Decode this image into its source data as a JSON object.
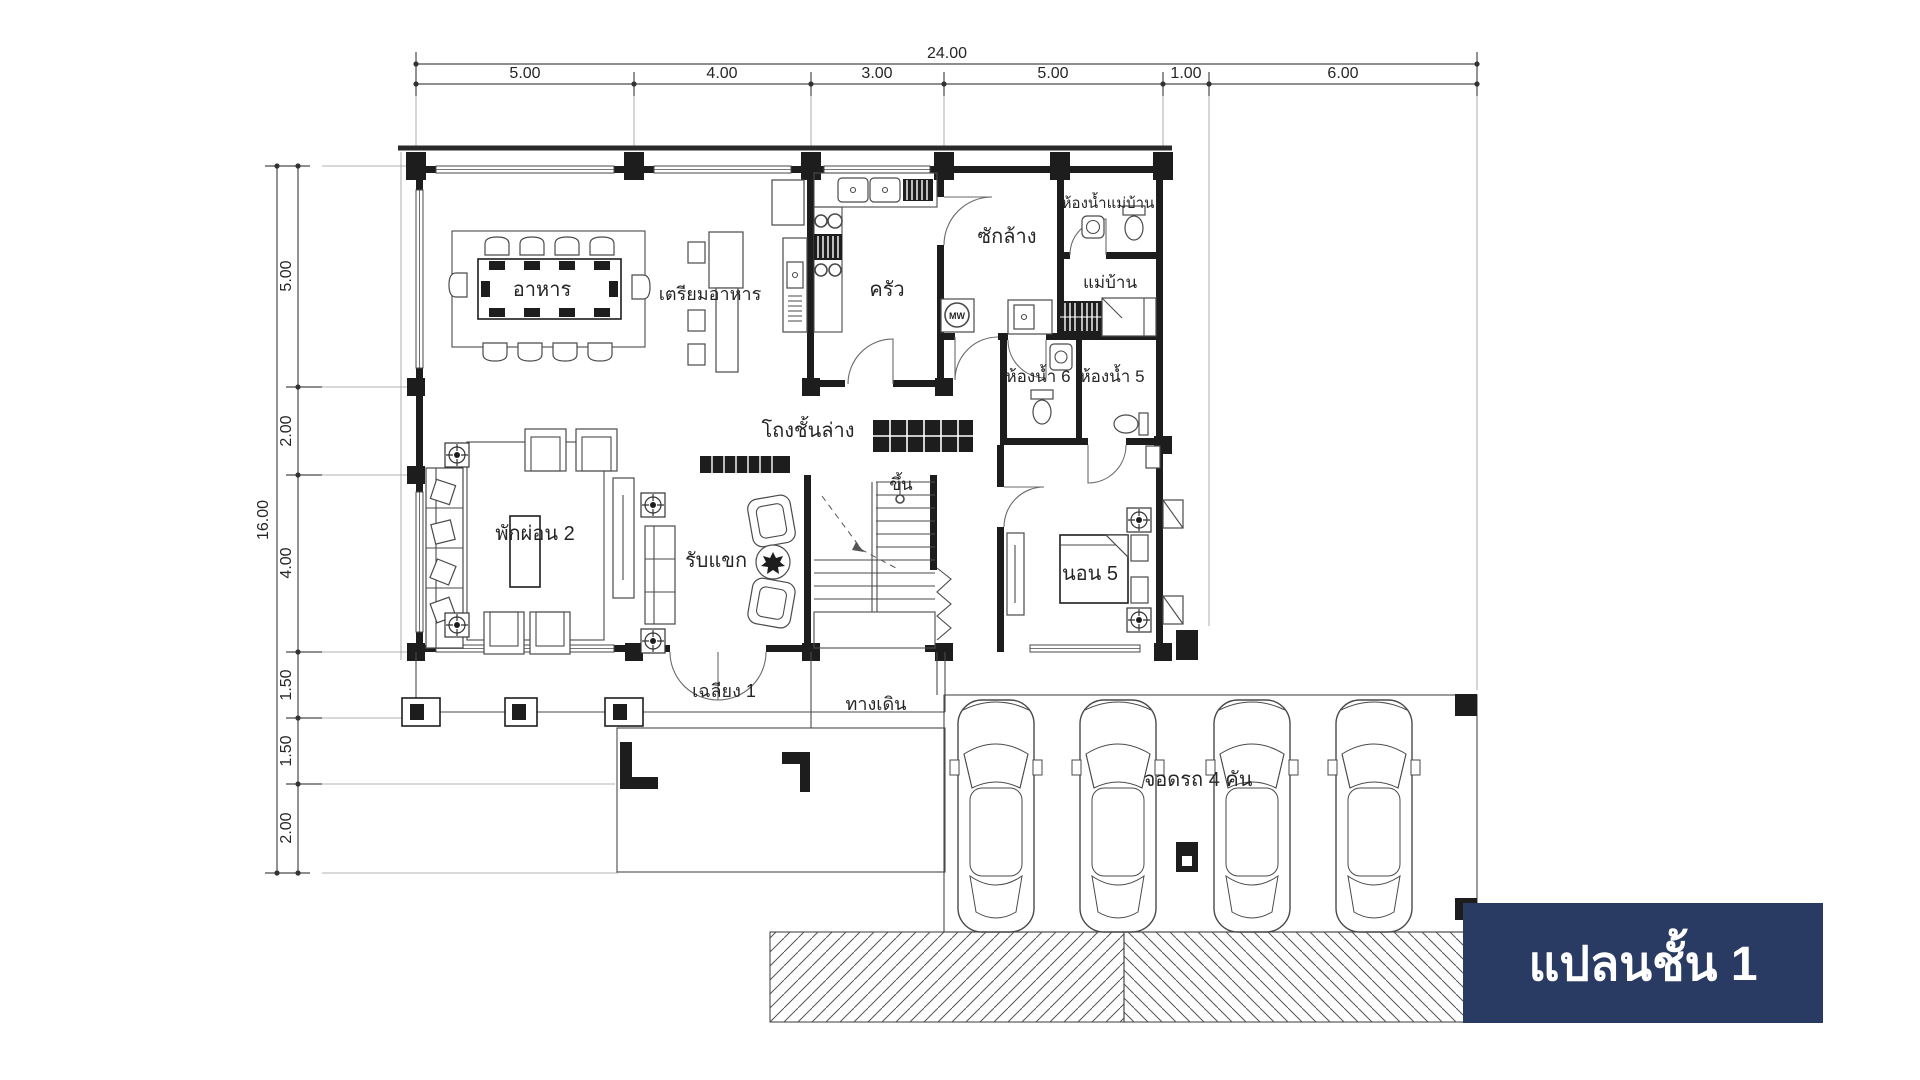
{
  "title_box": {
    "label": "แปลนชั้น 1",
    "bg": "#293b63",
    "text_color": "#ffffff"
  },
  "dimensions": {
    "top": {
      "total": "24.00",
      "segments": [
        "5.00",
        "4.00",
        "3.00",
        "5.00",
        "1.00",
        "6.00"
      ]
    },
    "left": {
      "total": "16.00",
      "segments": [
        "5.00",
        "2.00",
        "4.00",
        "1.50",
        "1.50",
        "2.00"
      ]
    }
  },
  "rooms": {
    "dining": {
      "label": "อาหาร"
    },
    "prep": {
      "label": "เตรียมอาหาร"
    },
    "kitchen": {
      "label": "ครัว"
    },
    "laundry": {
      "label": "ซักล้าง"
    },
    "maid_bath": {
      "label": "ห้องน้ำแม่บ้าน"
    },
    "maid": {
      "label": "แม่บ้าน"
    },
    "bath6": {
      "label": "ห้องน้ำ 6"
    },
    "bath5": {
      "label": "ห้องน้ำ 5"
    },
    "hall": {
      "label": "โถงชั้นล่าง"
    },
    "living": {
      "label": "พักผ่อน 2"
    },
    "guest": {
      "label": "รับแขก"
    },
    "stairs_up": {
      "label": "ขึ้น"
    },
    "bed5": {
      "label": "นอน 5"
    },
    "porch": {
      "label": "เฉลียง 1"
    },
    "walkway": {
      "label": "ทางเดิน"
    },
    "carport": {
      "label": "จอดรถ 4 คัน"
    },
    "microwave": {
      "label": "MW"
    }
  },
  "colors": {
    "wall": "#1d1d1d",
    "line": "#4a4a4a",
    "text": "#262626",
    "navy": "#293b63",
    "white": "#ffffff"
  }
}
